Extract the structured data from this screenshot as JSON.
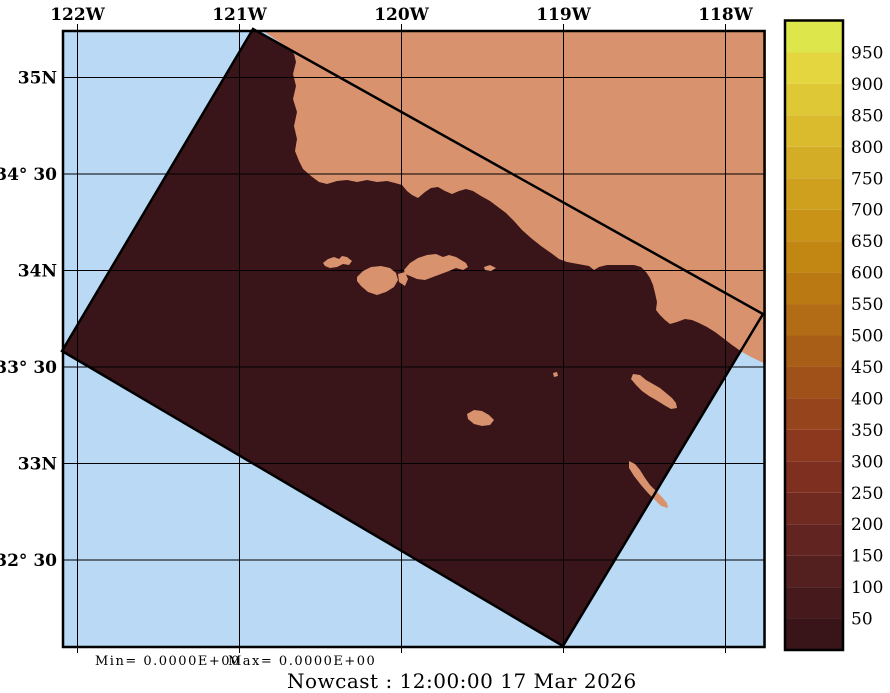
{
  "figure": {
    "kind": "ocean model nowcast map",
    "region": "Southern California Bight"
  },
  "annotations": {
    "min_label": "Min= 0.0000E+00",
    "max_label": "Max= 0.0000E+00",
    "footer": "Nowcast : 12:00:00  17 Mar 2026"
  },
  "axes": {
    "lon_labels": [
      "122W",
      "121W",
      "120W",
      "119W",
      "118W"
    ],
    "lat_labels": [
      "35N",
      "34° 30",
      "34N",
      "33° 30",
      "33N",
      "32° 30"
    ]
  },
  "map": {
    "ocean_color": "#b9d9f4",
    "land_color": "#d9926e",
    "data_color": "#391419",
    "outline_color": "#000000"
  },
  "colorbar": {
    "ticks": [
      "950",
      "900",
      "850",
      "800",
      "750",
      "700",
      "650",
      "600",
      "550",
      "500",
      "450",
      "400",
      "350",
      "300",
      "250",
      "200",
      "150",
      "100",
      "50"
    ],
    "colors": [
      "#dde74b",
      "#e4d63e",
      "#dfc836",
      "#dabb2e",
      "#d4ad26",
      "#cea01e",
      "#c89317",
      "#c28613",
      "#bb7913",
      "#b26c15",
      "#a95e18",
      "#a0511a",
      "#96441c",
      "#8b381e",
      "#7e2f20",
      "#702a20",
      "#622420",
      "#541f1f",
      "#46191c",
      "#391419"
    ]
  },
  "chart_data": {
    "type": "map",
    "title": "Nowcast : 12:00:00  17 Mar 2026",
    "x_ticks": [
      "122W",
      "121W",
      "120W",
      "119W",
      "118W"
    ],
    "y_ticks": [
      "35N",
      "34° 30",
      "34N",
      "33° 30",
      "33N",
      "32° 30"
    ],
    "colorbar_tick_values": [
      50,
      100,
      150,
      200,
      250,
      300,
      350,
      400,
      450,
      500,
      550,
      600,
      650,
      700,
      750,
      800,
      850,
      900,
      950
    ],
    "field_min": 0.0,
    "field_max": 0.0,
    "field_value_everywhere": 0,
    "notes": "Rotated model-domain swath filled with the 0-value color over ocean; land shown in salmon; background ocean light blue; lat/lon graticule at 1 deg lon / 0.5 deg lat"
  }
}
